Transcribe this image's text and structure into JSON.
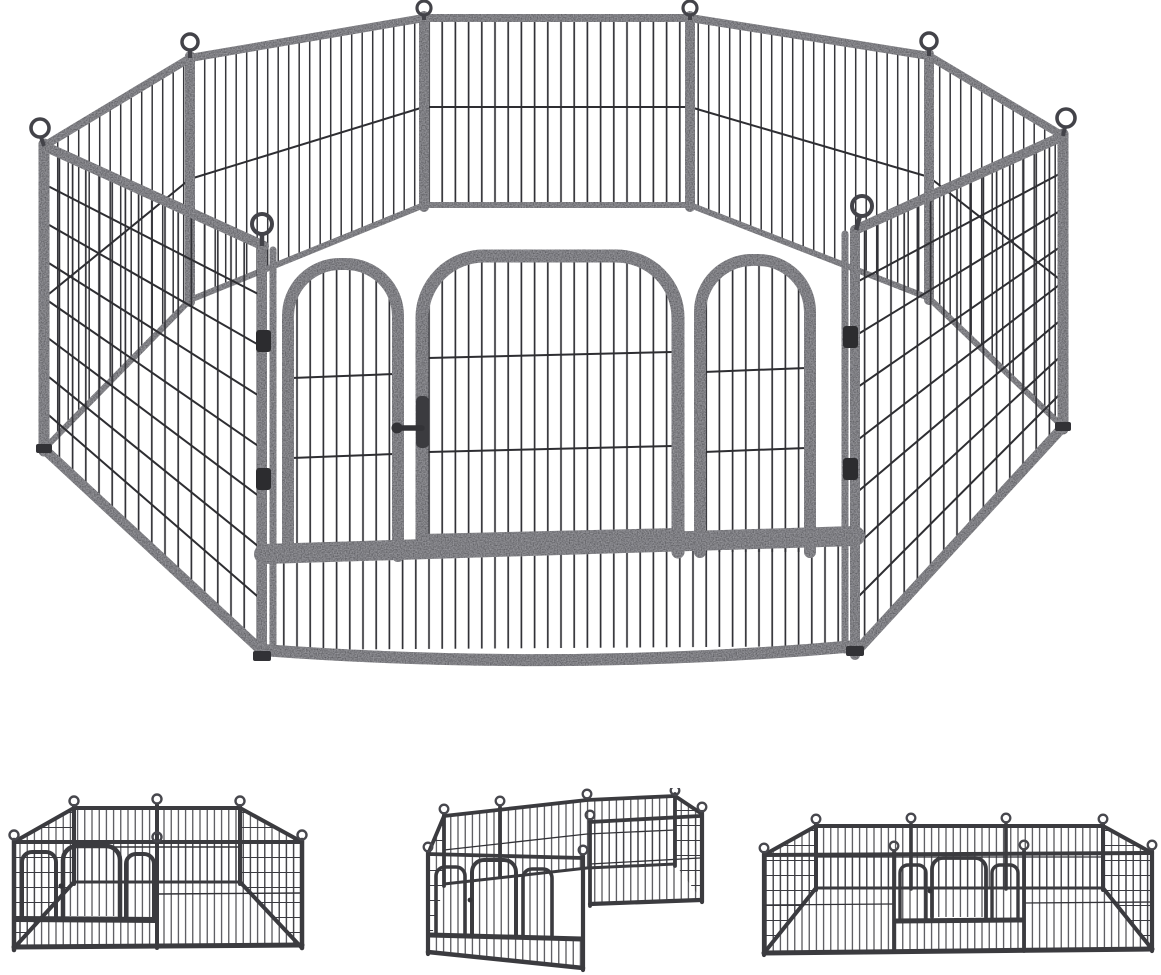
{
  "scene": {
    "type": "product-photo",
    "subject": "Heavy-duty metal pet playpen, 8 panels, hammered dark finish",
    "background_color": "#ffffff",
    "colors": {
      "frame": "#3b3b3f",
      "frame_dark": "#2c2c2f",
      "frame_highlight": "#84848c",
      "wire": "#313136",
      "background": "#ffffff"
    },
    "main_view": {
      "label": "8-panel metal playpen arranged as an octagon with front gate panel",
      "panel_count": 8,
      "features": [
        "loop-top corner connector pins",
        "arched walk-through gate door with slide latch",
        "two arched side sections on gate panel",
        "bottom kick bar with short vertical bars on gate panel",
        "fine grid mesh on large side panels",
        "vertical bar mesh with mid wire on back panels"
      ]
    },
    "thumbnails": [
      {
        "label": "square layout configuration",
        "panel_count": 8
      },
      {
        "label": "L-shaped two-room layout configuration",
        "panel_count": 8
      },
      {
        "label": "wide rectangle layout with centered gate",
        "panel_count": 8
      }
    ]
  }
}
